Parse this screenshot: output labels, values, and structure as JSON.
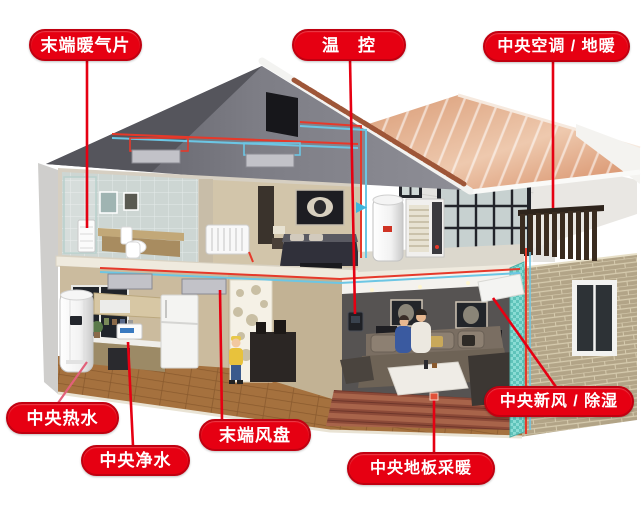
{
  "colors": {
    "label_bg": "#e60012",
    "label_border": "#c10010",
    "label_text": "#ffffff",
    "leader": "#e60012",
    "leader_soft": "#e2607a",
    "hot_pipe": "#e6392a",
    "cold_pipe": "#6cc6e4"
  },
  "labels": {
    "terminal_radiator": "末端暖气片",
    "thermostat": "温　控",
    "central_ac_floor_heating": "中央空调 / 地暖",
    "central_hot_water": "中央热水",
    "central_water_purifier": "中央净水",
    "terminal_fan_coil": "末端风盘",
    "central_floor_heating": "中央地板采暖",
    "central_fresh_air_dehumidification": "中央新风 / 除湿"
  }
}
